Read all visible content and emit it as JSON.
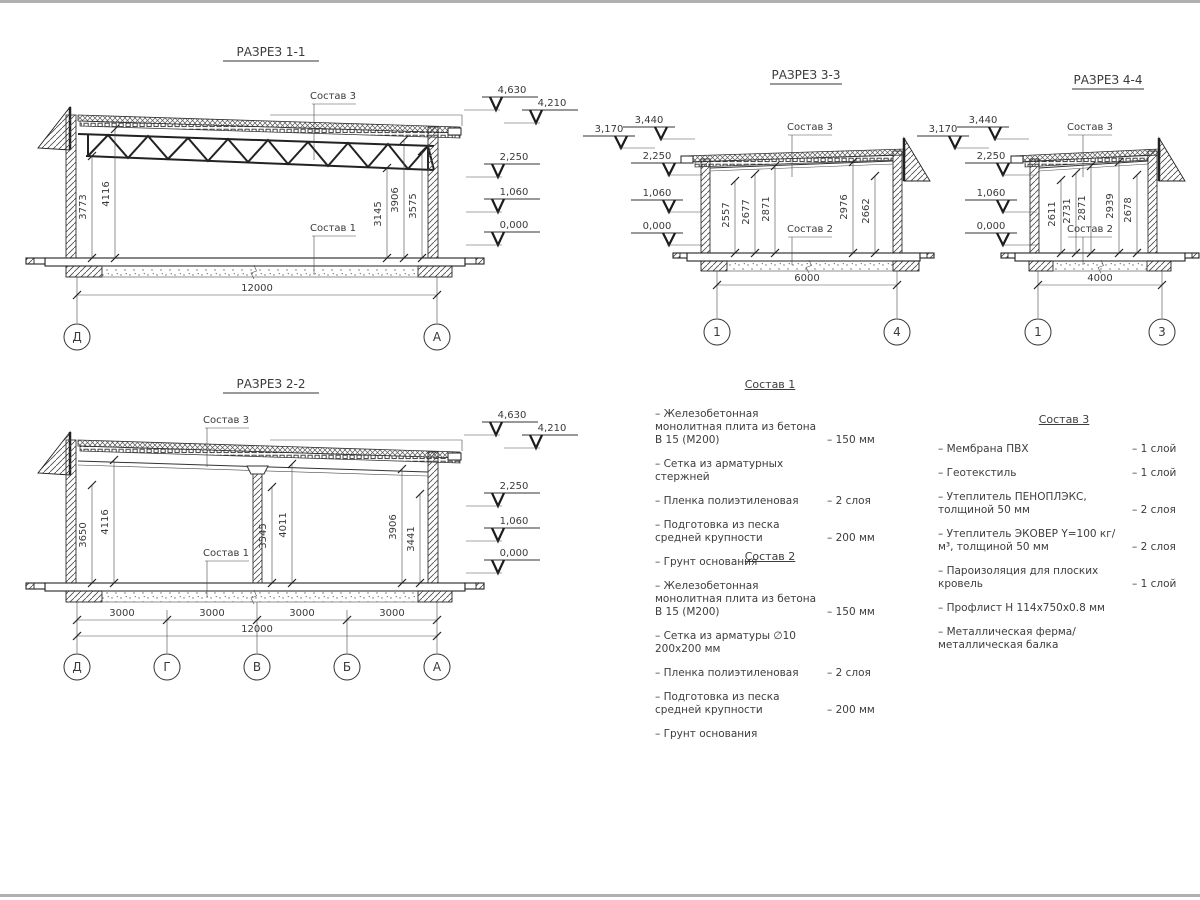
{
  "sections": {
    "s11": {
      "title": "РАЗРЕЗ 1-1",
      "roof_label": "Состав 3",
      "floor_label": "Состав 1",
      "dims": [
        "3773",
        "4116",
        "3145",
        "3906",
        "3575"
      ],
      "elevations": [
        "4,630",
        "4,210",
        "2,250",
        "1,060",
        "0,000"
      ],
      "overall_width": "12000",
      "axes": [
        "Д",
        "А"
      ]
    },
    "s22": {
      "title": "РАЗРЕЗ 2-2",
      "roof_label": "Состав 3",
      "floor_label": "Состав 1",
      "dims": [
        "3650",
        "4116",
        "3545",
        "4011",
        "3906",
        "3441"
      ],
      "elevations": [
        "4,630",
        "4,210",
        "2,250",
        "1,060",
        "0,000"
      ],
      "span_dims": [
        "3000",
        "3000",
        "3000",
        "3000"
      ],
      "overall_width": "12000",
      "axes": [
        "Д",
        "Г",
        "В",
        "Б",
        "А"
      ]
    },
    "s33": {
      "title": "РАЗРЕЗ 3-3",
      "roof_label": "Состав 3",
      "floor_label": "Состав 2",
      "dims": [
        "2557",
        "2677",
        "2871",
        "2976",
        "2662"
      ],
      "elevations": [
        "3,170",
        "3,440",
        "2,250",
        "1,060",
        "0,000"
      ],
      "overall_width": "6000",
      "axes": [
        "1",
        "4"
      ]
    },
    "s44": {
      "title": "РАЗРЕЗ 4-4",
      "roof_label": "Состав 3",
      "floor_label": "Состав 2",
      "dims": [
        "2611",
        "2731",
        "2871",
        "2939",
        "2678"
      ],
      "elevations": [
        "3,170",
        "3,440",
        "2,250",
        "1,060",
        "0,000"
      ],
      "overall_width": "4000",
      "axes": [
        "1",
        "3"
      ]
    }
  },
  "compositions": [
    {
      "title": "Состав 1",
      "items": [
        {
          "name": "– Железобетонная  монолитная плита из бетона В 15 (М200)",
          "value": "– 150 мм"
        },
        {
          "name": "– Сетка из арматурных стержней",
          "value": ""
        },
        {
          "name": "– Пленка полиэтиленовая",
          "value": "– 2 слоя"
        },
        {
          "name": "– Подготовка из песка средней крупности",
          "value": "– 200 мм"
        },
        {
          "name": "– Грунт основания",
          "value": ""
        }
      ]
    },
    {
      "title": "Состав 2",
      "items": [
        {
          "name": "– Железобетонная  монолитная плита из бетона В 15 (М200)",
          "value": "– 150 мм"
        },
        {
          "name": "– Сетка из арматуры ∅10 200x200 мм",
          "value": ""
        },
        {
          "name": "– Пленка полиэтиленовая",
          "value": "– 2 слоя"
        },
        {
          "name": "– Подготовка из песка средней крупности",
          "value": "– 200 мм"
        },
        {
          "name": "– Грунт основания",
          "value": ""
        }
      ]
    },
    {
      "title": "Состав 3",
      "items": [
        {
          "name": "– Мембрана ПВХ",
          "value": "– 1 слой"
        },
        {
          "name": "– Геотекстиль",
          "value": "– 1 слой"
        },
        {
          "name": "– Утеплитель ПЕНОПЛЭКС, толщиной 50 мм",
          "value": "– 2 слоя"
        },
        {
          "name": "– Утеплитель ЭКОВЕР Y=100 кг/м³, толщиной 50 мм",
          "value": "– 2 слоя"
        },
        {
          "name": "– Пароизоляция для плоских кровель",
          "value": "– 1 слой"
        },
        {
          "name": "– Профлист Н 114x750x0.8 мм",
          "value": ""
        },
        {
          "name": "– Металлическая ферма/ металлическая балка",
          "value": ""
        }
      ]
    }
  ]
}
